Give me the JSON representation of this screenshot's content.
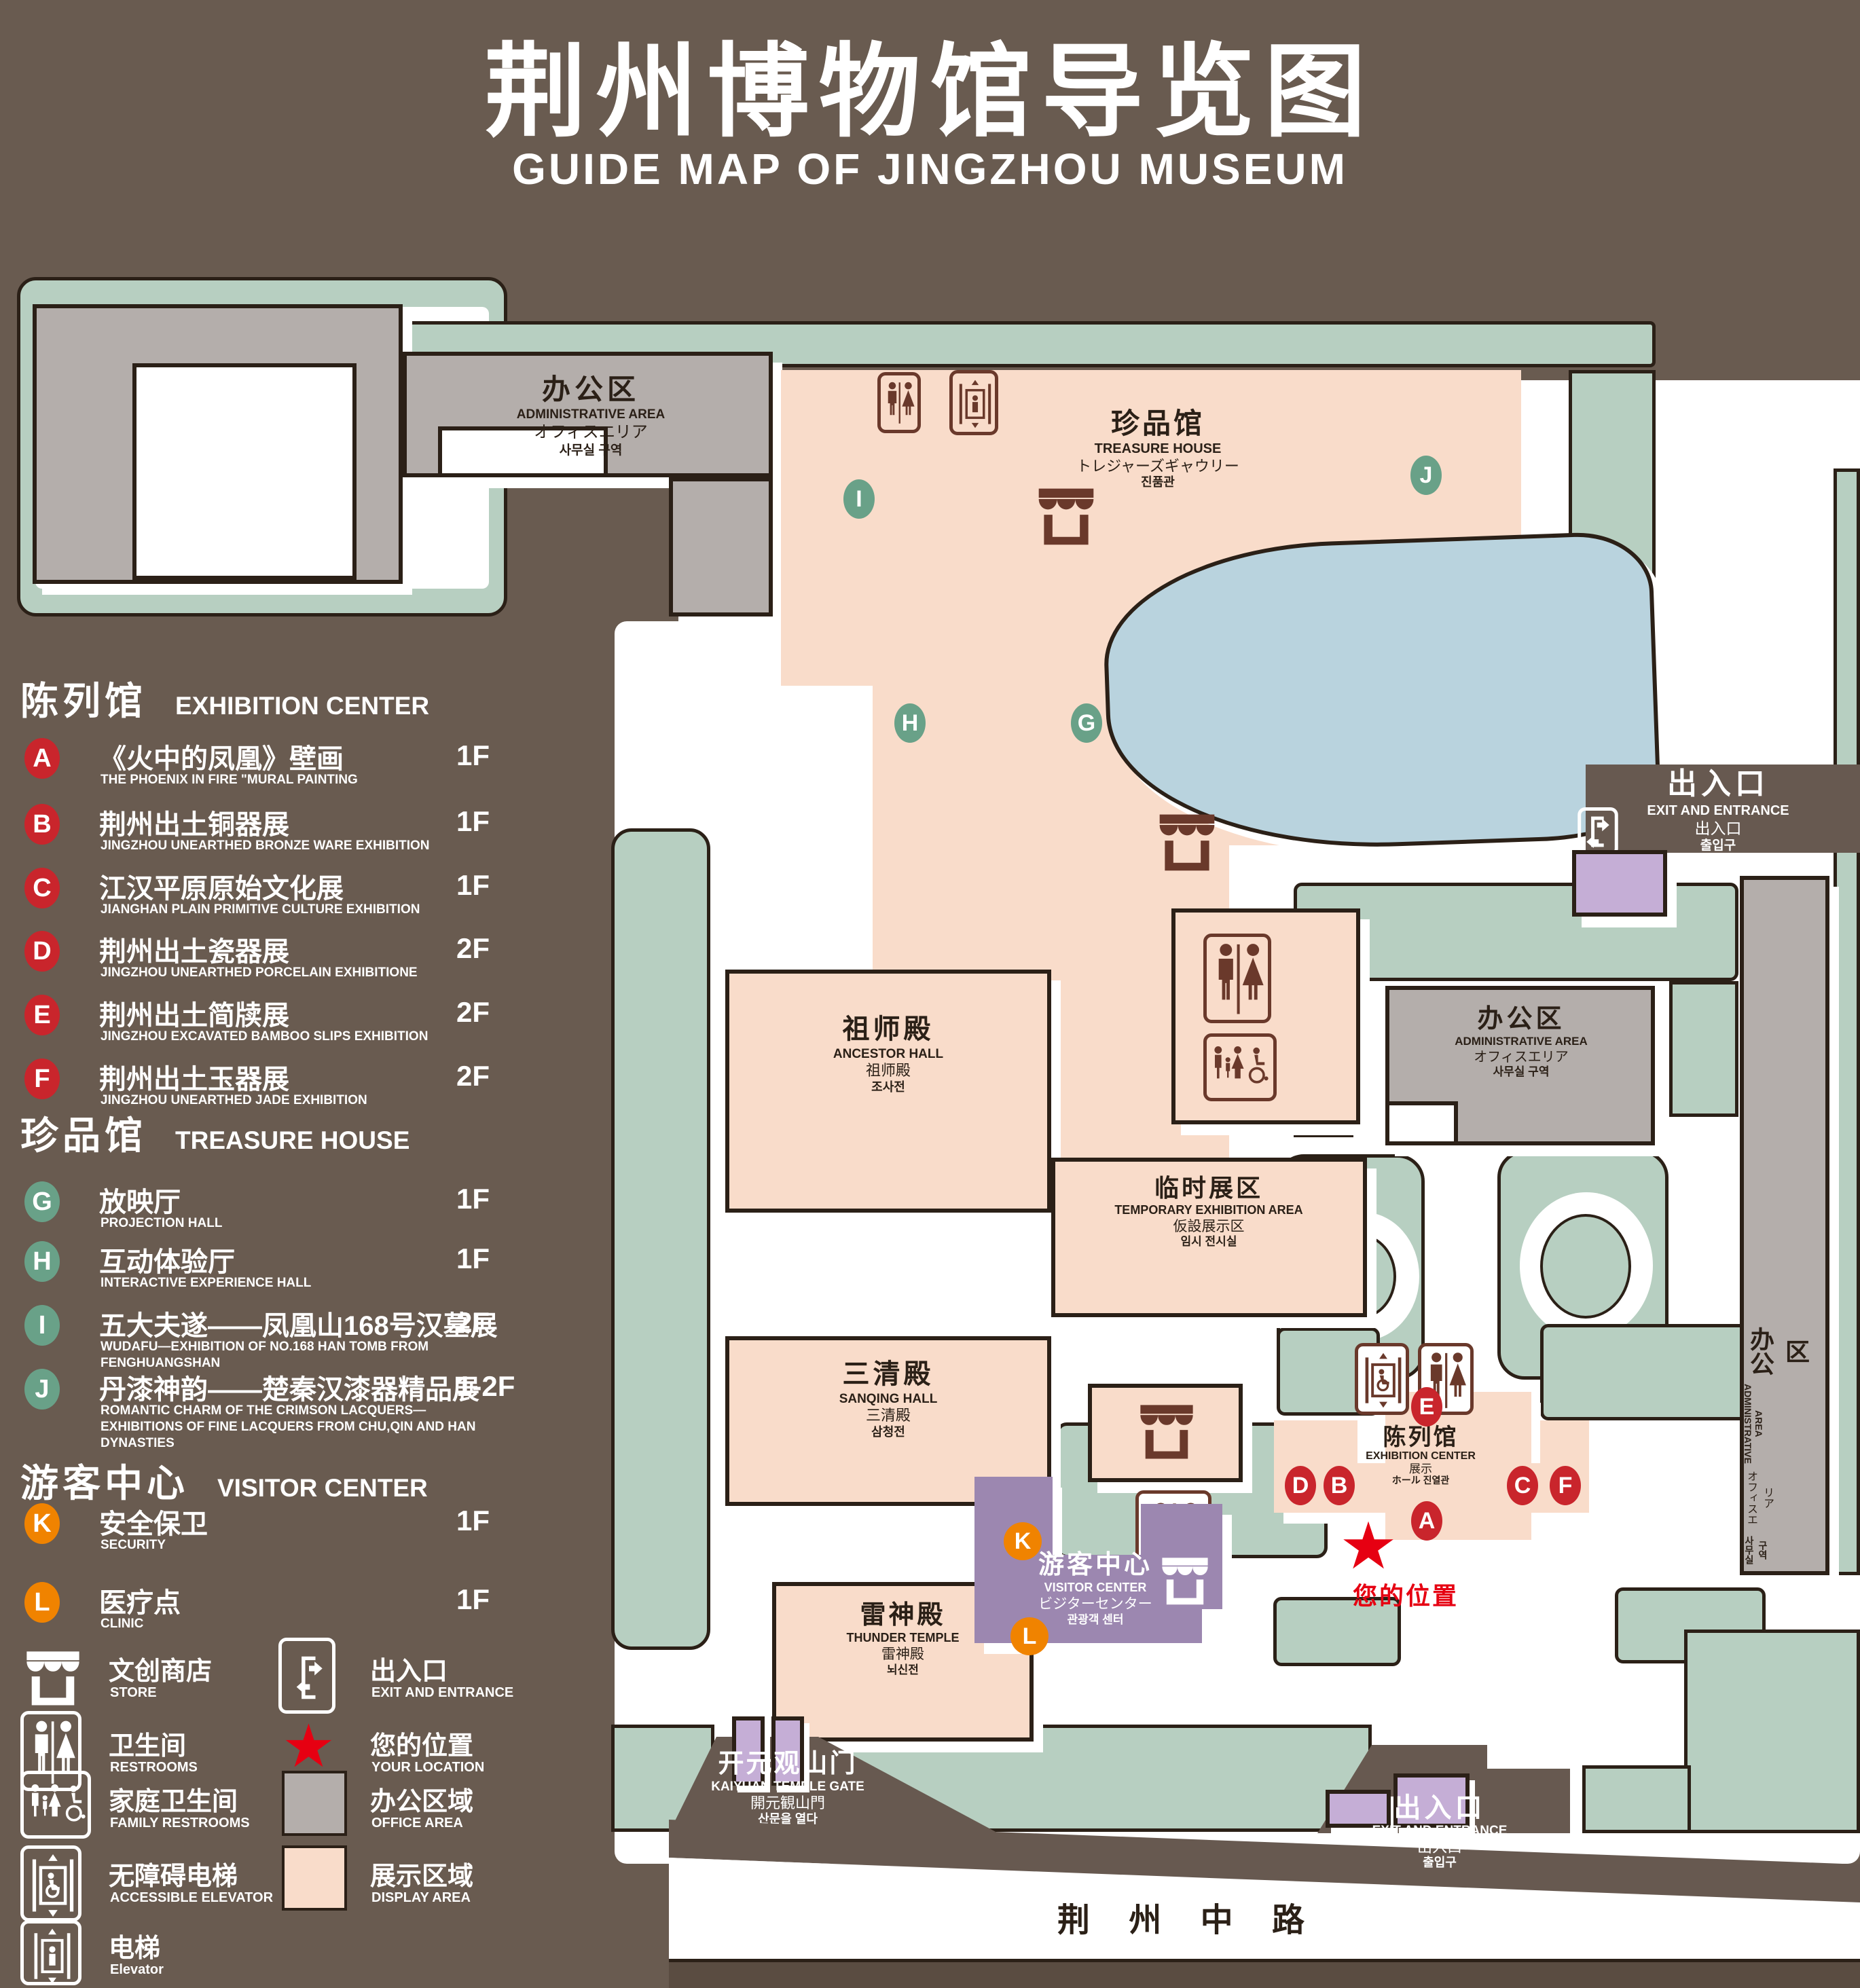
{
  "title": {
    "zh": "荆州博物馆导览图",
    "en": "GUIDE MAP OF JINGZHOU MUSEUM"
  },
  "colors": {
    "background": "#695b50",
    "green": "#b7cfc1",
    "display_pink": "#f9dcca",
    "office_gray": "#b4aeab",
    "water_blue": "#b9d3de",
    "visitor_purple": "#9c87b0",
    "gate_purple": "#c5aed6",
    "badge_red": "#c9252c",
    "badge_green": "#69a188",
    "badge_orange": "#f08300",
    "location_red": "#e60012",
    "outline": "#2b2017"
  },
  "legend": {
    "sections": [
      {
        "zh": "陈列馆",
        "en": "EXHIBITION CENTER",
        "items": [
          {
            "letter": "A",
            "zh": "《火中的凤凰》壁画",
            "en": "THE PHOENIX IN FIRE \"MURAL PAINTING",
            "floor": "1F"
          },
          {
            "letter": "B",
            "zh": "荆州出土铜器展",
            "en": "JINGZHOU UNEARTHED BRONZE WARE EXHIBITION",
            "floor": "1F"
          },
          {
            "letter": "C",
            "zh": "江汉平原原始文化展",
            "en": "JIANGHAN PLAIN PRIMITIVE CULTURE EXHIBITION",
            "floor": "1F"
          },
          {
            "letter": "D",
            "zh": "荆州出土瓷器展",
            "en": "JINGZHOU UNEARTHED PORCELAIN EXHIBITIONE",
            "floor": "2F"
          },
          {
            "letter": "E",
            "zh": "荆州出土简牍展",
            "en": "JINGZHOU EXCAVATED BAMBOO SLIPS EXHIBITION",
            "floor": "2F"
          },
          {
            "letter": "F",
            "zh": "荆州出土玉器展",
            "en": "JINGZHOU UNEARTHED JADE EXHIBITION",
            "floor": "2F"
          }
        ]
      },
      {
        "zh": "珍品馆",
        "en": "TREASURE HOUSE",
        "items": [
          {
            "letter": "G",
            "zh": "放映厅",
            "en": "PROJECTION HALL",
            "floor": "1F"
          },
          {
            "letter": "H",
            "zh": "互动体验厅",
            "en": "INTERACTIVE EXPERIENCE HALL",
            "floor": "1F"
          },
          {
            "letter": "I",
            "zh": "五大夫遂——凤凰山168号汉墓展",
            "en": "WUDAFU—EXHIBITION OF NO.168 HAN TOMB FROM FENGHUANGSHAN",
            "floor": "2F"
          },
          {
            "letter": "J",
            "zh": "丹漆神韵——楚秦汉漆器精品展",
            "en": "ROMANTIC CHARM OF THE CRIMSON LACQUERS—EXHIBITIONS OF FINE LACQUERS FROM CHU,QIN AND HAN DYNASTIES",
            "floor": "1-2F"
          }
        ]
      },
      {
        "zh": "游客中心",
        "en": "VISITOR CENTER",
        "items": [
          {
            "letter": "K",
            "zh": "安全保卫",
            "en": "SECURITY",
            "floor": "1F"
          },
          {
            "letter": "L",
            "zh": "医疗点",
            "en": "CLINIC",
            "floor": "1F"
          }
        ]
      }
    ],
    "symbols": [
      {
        "icon": "store-icon",
        "zh": "文创商店",
        "en": "STORE"
      },
      {
        "icon": "exit-icon",
        "zh": "出入口",
        "en": "EXIT AND ENTRANCE"
      },
      {
        "icon": "restroom-icon",
        "zh": "卫生间",
        "en": "RESTROOMS"
      },
      {
        "icon": "location-star-icon",
        "zh": "您的位置",
        "en": "YOUR LOCATION"
      },
      {
        "icon": "family-restroom-icon",
        "zh": "家庭卫生间",
        "en": "FAMILY RESTROOMS"
      },
      {
        "icon": "office-area-swatch",
        "zh": "办公区域",
        "en": "OFFICE AREA"
      },
      {
        "icon": "accessible-elevator-icon",
        "zh": "无障碍电梯",
        "en": "ACCESSIBLE ELEVATOR"
      },
      {
        "icon": "display-area-swatch",
        "zh": "展示区域",
        "en": "DISPLAY AREA"
      },
      {
        "icon": "elevator-icon",
        "zh": "电梯",
        "en": "Elevator"
      }
    ]
  },
  "map": {
    "admin_top": {
      "zh": "办公区",
      "en": "ADMINISTRATIVE AREA",
      "ja": "オフィスエリア",
      "ko": "사무실 구역"
    },
    "admin_mid": {
      "zh": "办公区",
      "en": "ADMINISTRATIVE AREA",
      "ja": "オフィスエリア",
      "ko": "사무실 구역"
    },
    "admin_right": {
      "zh": "办公区",
      "en": "ADMINISTRATIVE AREA",
      "ja": "オフィスエリア",
      "ko": "사무실 구역"
    },
    "treasure": {
      "zh": "珍品馆",
      "en": "TREASURE HOUSE",
      "ja": "トレジャーズギャウリー",
      "ko": "진품관"
    },
    "ancestor": {
      "zh": "祖师殿",
      "en": "ANCESTOR HALL",
      "ja": "祖师殿",
      "ko": "조사전"
    },
    "temporary": {
      "zh": "临时展区",
      "en": "TEMPORARY EXHIBITION AREA",
      "ja": "仮設展示区",
      "ko": "임시 전시실"
    },
    "sanqing": {
      "zh": "三清殿",
      "en": "SANQING HALL",
      "ja": "三清殿",
      "ko": "삼청전"
    },
    "thunder": {
      "zh": "雷神殿",
      "en": "THUNDER TEMPLE",
      "ja": "雷神殿",
      "ko": "뇌신전"
    },
    "visitor": {
      "zh": "游客中心",
      "en": "VISITOR CENTER",
      "ja": "ビジターセンター",
      "ko": "관광객 센터"
    },
    "exhibition": {
      "zh": "陈列馆",
      "en": "EXHIBITION CENTER",
      "ja": "展示",
      "ko": "ホール 진열관"
    },
    "gate": {
      "zh": "开元观山门",
      "en": "KAIYUAN TEMPLE GATE",
      "ja": "開元観山門",
      "ko": "산문을 열다"
    },
    "exit_top": {
      "zh": "出入口",
      "en": "EXIT AND ENTRANCE",
      "ja": "出入口",
      "ko": "출입구"
    },
    "exit_bottom": {
      "zh": "出入口",
      "en": "EXIT AND ENTRANCE",
      "ja": "出入口",
      "ko": "출입구"
    },
    "road": "荆 州 中 路",
    "your_location": "您的位置",
    "markers": {
      "A": "A",
      "B": "B",
      "C": "C",
      "D": "D",
      "E": "E",
      "F": "F",
      "G": "G",
      "H": "H",
      "I": "I",
      "J": "J",
      "K": "K",
      "L": "L"
    }
  }
}
